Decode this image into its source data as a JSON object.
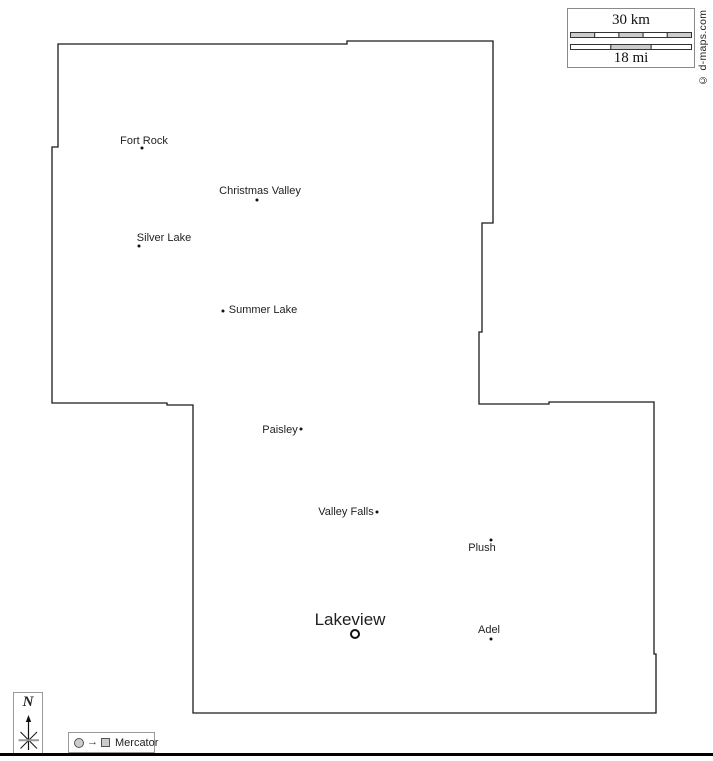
{
  "copyright": "© d-maps.com",
  "scale": {
    "km_label": "30 km",
    "mi_label": "18 mi",
    "km_segment_fills": [
      "#cccccc",
      "#ffffff",
      "#cccccc",
      "#ffffff",
      "#cccccc"
    ],
    "mi_segment_fills": [
      "#ffffff",
      "#cccccc",
      "#ffffff"
    ],
    "bar_stroke": "#333333"
  },
  "compass": {
    "label": "N"
  },
  "legend": {
    "projection": "Mercator"
  },
  "map": {
    "stroke_color": "#1a1a1a",
    "boundary": [
      [
        58,
        44
      ],
      [
        347,
        44
      ],
      [
        347,
        41
      ],
      [
        493,
        41
      ],
      [
        493,
        223
      ],
      [
        482,
        223
      ],
      [
        482,
        332
      ],
      [
        479,
        332
      ],
      [
        479,
        404
      ],
      [
        549,
        404
      ],
      [
        549,
        402
      ],
      [
        654,
        402
      ],
      [
        654,
        654
      ],
      [
        656,
        654
      ],
      [
        656,
        713
      ],
      [
        193,
        713
      ],
      [
        193,
        405
      ],
      [
        167,
        405
      ],
      [
        167,
        403
      ],
      [
        52,
        403
      ],
      [
        52,
        147
      ],
      [
        58,
        147
      ]
    ],
    "cities": [
      {
        "name": "Fort Rock",
        "marker": "dot",
        "dot": [
          142,
          148
        ],
        "label": [
          144,
          141
        ],
        "size": 11
      },
      {
        "name": "Christmas Valley",
        "marker": "dot",
        "dot": [
          257,
          200
        ],
        "label": [
          260,
          191
        ],
        "size": 11
      },
      {
        "name": "Silver Lake",
        "marker": "dot",
        "dot": [
          139,
          246
        ],
        "label": [
          164,
          238
        ],
        "size": 11
      },
      {
        "name": "Summer Lake",
        "marker": "dot",
        "dot": [
          223,
          311
        ],
        "label": [
          263,
          310
        ],
        "size": 11
      },
      {
        "name": "Paisley",
        "marker": "dot",
        "dot": [
          301,
          429
        ],
        "label": [
          280,
          430
        ],
        "size": 11
      },
      {
        "name": "Valley Falls",
        "marker": "dot",
        "dot": [
          377,
          512
        ],
        "label": [
          346,
          512
        ],
        "size": 11
      },
      {
        "name": "Plush",
        "marker": "dot",
        "dot": [
          491,
          540
        ],
        "label": [
          482,
          548
        ],
        "size": 11
      },
      {
        "name": "Lakeview",
        "marker": "ring",
        "dot": [
          355,
          634
        ],
        "label": [
          350,
          620
        ],
        "size": 17
      },
      {
        "name": "Adel",
        "marker": "dot",
        "dot": [
          491,
          639
        ],
        "label": [
          489,
          630
        ],
        "size": 11
      }
    ]
  }
}
